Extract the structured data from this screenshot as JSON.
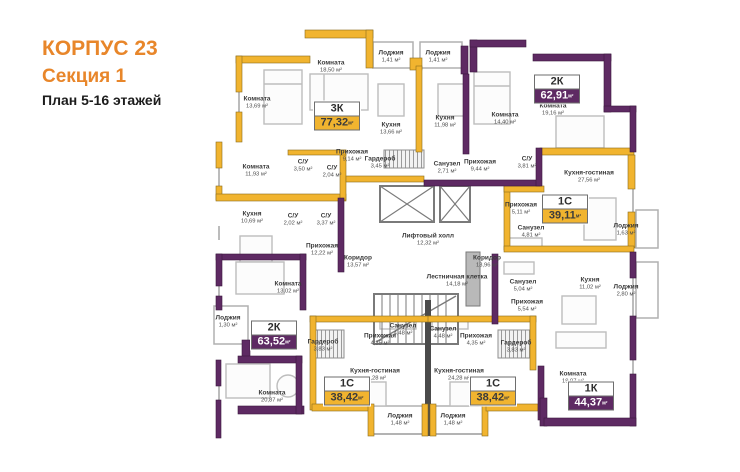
{
  "header": {
    "building": "КОРПУС 23",
    "section": "Секция 1",
    "plan": "План 5-16 этажей"
  },
  "colors": {
    "orange": "#E8862A",
    "wall_yellow": "#F1B42F",
    "wall_purple": "#5E2A63"
  },
  "area_unit": "м²",
  "apartments": [
    {
      "type": "3К",
      "area": "77,32",
      "style": "yellow",
      "x": 337,
      "y": 116
    },
    {
      "type": "2К",
      "area": "62,91",
      "style": "purple",
      "x": 557,
      "y": 89
    },
    {
      "type": "1С",
      "area": "39,11",
      "style": "yellow",
      "x": 565,
      "y": 209
    },
    {
      "type": "2К",
      "area": "63,52",
      "style": "purple",
      "x": 274,
      "y": 335
    },
    {
      "type": "1С",
      "area": "38,42",
      "style": "yellow",
      "x": 347,
      "y": 391
    },
    {
      "type": "1С",
      "area": "38,42",
      "style": "yellow",
      "x": 493,
      "y": 391
    },
    {
      "type": "1К",
      "area": "44,37",
      "style": "purple",
      "x": 591,
      "y": 396
    }
  ],
  "rooms": [
    {
      "name": "Комната",
      "area": "13,69",
      "x": 257,
      "y": 103
    },
    {
      "name": "Комната",
      "area": "18,50",
      "x": 331,
      "y": 67
    },
    {
      "name": "Лоджия",
      "area": "1,41",
      "x": 391,
      "y": 57
    },
    {
      "name": "Лоджия",
      "area": "1,41",
      "x": 438,
      "y": 57
    },
    {
      "name": "Кухня",
      "area": "13,66",
      "x": 391,
      "y": 129
    },
    {
      "name": "Кухня",
      "area": "11,98",
      "x": 445,
      "y": 122
    },
    {
      "name": "Комната",
      "area": "14,40",
      "x": 505,
      "y": 119
    },
    {
      "name": "Комната",
      "area": "19,16",
      "x": 553,
      "y": 110
    },
    {
      "name": "Прихожая",
      "area": "9,14",
      "x": 352,
      "y": 156
    },
    {
      "name": "Гардероб",
      "area": "3,45",
      "x": 380,
      "y": 163
    },
    {
      "name": "С/У",
      "area": "3,50",
      "x": 303,
      "y": 166
    },
    {
      "name": "С/У",
      "area": "2,04",
      "x": 332,
      "y": 172
    },
    {
      "name": "Санузел",
      "area": "2,71",
      "x": 447,
      "y": 168
    },
    {
      "name": "Прихожая",
      "area": "9,44",
      "x": 480,
      "y": 166
    },
    {
      "name": "С/У",
      "area": "3,81",
      "x": 527,
      "y": 163
    },
    {
      "name": "Комната",
      "area": "11,93",
      "x": 256,
      "y": 171
    },
    {
      "name": "Кухня-гостиная",
      "area": "27,56",
      "x": 589,
      "y": 177
    },
    {
      "name": "Прихожая",
      "area": "5,11",
      "x": 521,
      "y": 209
    },
    {
      "name": "Кухня",
      "area": "10,69",
      "x": 252,
      "y": 218
    },
    {
      "name": "С/У",
      "area": "2,02",
      "x": 293,
      "y": 220
    },
    {
      "name": "С/У",
      "area": "3,37",
      "x": 326,
      "y": 220
    },
    {
      "name": "Санузел",
      "area": "4,81",
      "x": 531,
      "y": 232
    },
    {
      "name": "Лоджия",
      "area": "1,63",
      "x": 626,
      "y": 230
    },
    {
      "name": "Лифтовый холл",
      "area": "12,32",
      "x": 428,
      "y": 240
    },
    {
      "name": "Прихожая",
      "area": "12,22",
      "x": 322,
      "y": 250
    },
    {
      "name": "Коридор",
      "area": "13,57",
      "x": 358,
      "y": 262
    },
    {
      "name": "Коридор",
      "area": "13,96",
      "x": 487,
      "y": 262
    },
    {
      "name": "Лестничная клетка",
      "area": "14,18",
      "x": 457,
      "y": 281
    },
    {
      "name": "Комната",
      "area": "13,02",
      "x": 288,
      "y": 288
    },
    {
      "name": "Санузел",
      "area": "5,04",
      "x": 523,
      "y": 286
    },
    {
      "name": "Кухня",
      "area": "11,02",
      "x": 590,
      "y": 284
    },
    {
      "name": "Лоджия",
      "area": "2,80",
      "x": 626,
      "y": 291
    },
    {
      "name": "Прихожая",
      "area": "5,54",
      "x": 527,
      "y": 306
    },
    {
      "name": "Лоджия",
      "area": "1,30",
      "x": 228,
      "y": 322
    },
    {
      "name": "Санузел",
      "area": "4,48",
      "x": 403,
      "y": 330
    },
    {
      "name": "Санузел",
      "area": "4,48",
      "x": 443,
      "y": 333
    },
    {
      "name": "Прихожая",
      "area": "4,35",
      "x": 380,
      "y": 340
    },
    {
      "name": "Прихожая",
      "area": "4,35",
      "x": 476,
      "y": 340
    },
    {
      "name": "Гардероб",
      "area": "3,83",
      "x": 323,
      "y": 346
    },
    {
      "name": "Гардероб",
      "area": "3,83",
      "x": 516,
      "y": 347
    },
    {
      "name": "Кухня-гостиная",
      "area": "24,28",
      "x": 375,
      "y": 375
    },
    {
      "name": "Кухня-гостиная",
      "area": "24,28",
      "x": 459,
      "y": 375
    },
    {
      "name": "Комната",
      "area": "20,87",
      "x": 272,
      "y": 397
    },
    {
      "name": "Комната",
      "area": "19,97",
      "x": 573,
      "y": 378
    },
    {
      "name": "Лоджия",
      "area": "1,48",
      "x": 400,
      "y": 420
    },
    {
      "name": "Лоджия",
      "area": "1,48",
      "x": 453,
      "y": 420
    }
  ]
}
